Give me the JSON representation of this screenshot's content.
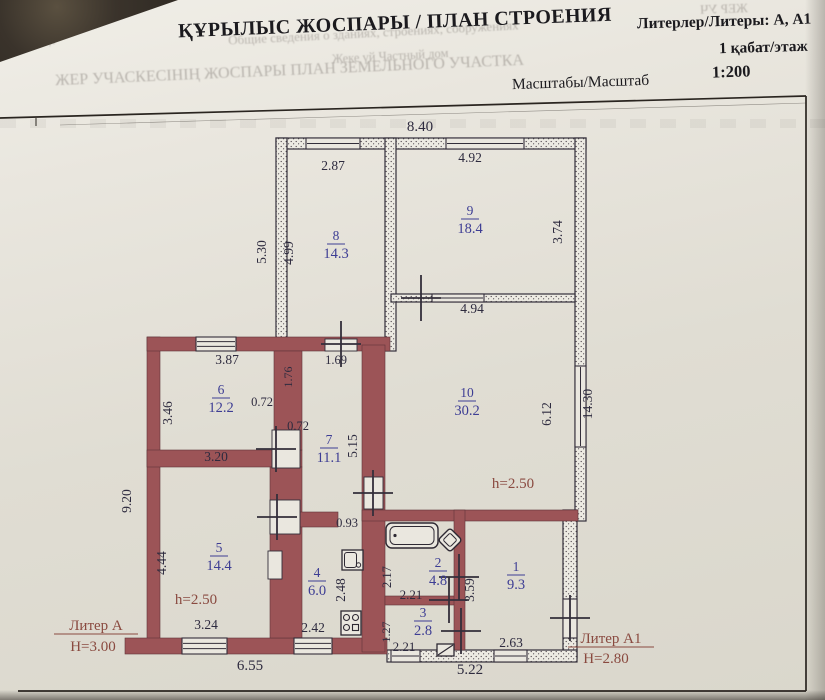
{
  "header": {
    "title": "ҚҰРЫЛЫС ЖОСПАРЫ / ПЛАН СТРОЕНИЯ",
    "liters": "Литерлер/Литеры: А, А1",
    "floor": "1 қабат/этаж",
    "scale_label": "Масштабы/Масштаб",
    "scale_value": "1:200"
  },
  "bleedthrough": [
    {
      "text": "Общие сведения о зданиях, строениях, сооружениях",
      "x": 228,
      "y": 25,
      "size": 13,
      "rot": -3,
      "mir": false
    },
    {
      "text": "Жеке үй    Частный дом",
      "x": 332,
      "y": 49,
      "size": 12.5,
      "rot": -3,
      "mir": false
    },
    {
      "text": "ЖЕР УЧАСКЕСІНІҢ ЖОСПАРЫ  ПЛАН ЗЕМЕЛЬНОГО УЧАСТКА",
      "x": 55,
      "y": 62,
      "size": 16,
      "rot": -2.5,
      "mir": false
    },
    {
      "text": "ЖЕР УЧ",
      "x": 700,
      "y": 1,
      "size": 13,
      "rot": 2,
      "mir": true
    },
    {
      "text": "қызметтер",
      "x": 2,
      "y": 34,
      "size": 12,
      "rot": 2,
      "mir": true
    }
  ],
  "colors": {
    "wall": "#9c5457",
    "wall_edge": "#5f3439",
    "line": "#332e3a",
    "hatch_bg": "#eceae2",
    "hatch_dot": "#4c434b",
    "dim_text": "#2e2b3f",
    "room_text": "#3d3d94",
    "note_text": "#8a4a40",
    "frame": "#2a2520",
    "fixture": "#2e2933",
    "white": "#eae7df"
  },
  "plan": {
    "frame": {
      "top_y": 96,
      "right_x": 806,
      "bottom_y": 691,
      "left_x": 36
    },
    "walls_solid": [
      [
        147,
        337,
        13,
        316
      ],
      [
        147,
        337,
        243,
        14
      ],
      [
        125,
        638,
        262,
        16
      ],
      [
        147,
        450,
        155,
        17
      ],
      [
        274,
        351,
        28,
        99
      ],
      [
        270,
        467,
        32,
        171
      ],
      [
        274,
        512,
        64,
        15
      ],
      [
        362,
        345,
        23,
        307
      ],
      [
        362,
        510,
        216,
        11
      ],
      [
        385,
        596,
        75,
        9
      ],
      [
        454,
        510,
        11,
        140
      ]
    ],
    "walls_hatched": [
      [
        276,
        138,
        310,
        11
      ],
      [
        276,
        138,
        11,
        213
      ],
      [
        385,
        138,
        11,
        213
      ],
      [
        575,
        138,
        11,
        383
      ],
      [
        391,
        294,
        184,
        8
      ],
      [
        563,
        510,
        14,
        148
      ],
      [
        387,
        650,
        190,
        12
      ]
    ],
    "windows": [
      {
        "r": [
          306,
          138,
          54,
          11
        ],
        "lines": 1
      },
      {
        "r": [
          446,
          138,
          78,
          11
        ],
        "lines": 1
      },
      {
        "r": [
          196,
          337,
          40,
          14
        ],
        "lines": 2
      },
      {
        "r": [
          182,
          638,
          45,
          16
        ],
        "lines": 2
      },
      {
        "r": [
          294,
          638,
          38,
          16
        ],
        "lines": 2
      },
      {
        "r": [
          575,
          366,
          11,
          81
        ],
        "lines": 1
      },
      {
        "r": [
          563,
          599,
          14,
          39
        ],
        "lines": 0
      },
      {
        "r": [
          432,
          294,
          52,
          8
        ],
        "lines": 1
      },
      {
        "r": [
          494,
          650,
          33,
          12
        ],
        "lines": 1
      },
      {
        "r": [
          391,
          650,
          29,
          12
        ],
        "lines": 1
      }
    ],
    "door_boxes": [
      [
        272,
        430,
        28,
        38
      ],
      [
        270,
        500,
        30,
        34
      ],
      [
        268,
        551,
        14,
        28
      ],
      [
        364,
        477,
        19,
        32
      ],
      [
        325,
        339,
        32,
        12
      ]
    ],
    "door_crosses": [
      [
        341,
        344
      ],
      [
        421,
        298
      ],
      [
        276,
        449
      ],
      [
        277,
        517
      ],
      [
        373,
        493
      ],
      [
        449,
        600
      ],
      [
        459,
        577
      ],
      [
        461,
        631
      ],
      [
        570,
        618
      ]
    ],
    "rooms": [
      {
        "number": "8",
        "area": "14.3",
        "x": 336,
        "y": 243
      },
      {
        "number": "9",
        "area": "18.4",
        "x": 470,
        "y": 218
      },
      {
        "number": "10",
        "area": "30.2",
        "x": 467,
        "y": 400
      },
      {
        "number": "6",
        "area": "12.2",
        "x": 221,
        "y": 397
      },
      {
        "number": "7",
        "area": "11.1",
        "x": 329,
        "y": 447
      },
      {
        "number": "5",
        "area": "14.4",
        "x": 219,
        "y": 555
      },
      {
        "number": "4",
        "area": "6.0",
        "x": 317,
        "y": 580
      },
      {
        "number": "2",
        "area": "4.8",
        "x": 438,
        "y": 570
      },
      {
        "number": "3",
        "area": "2.8",
        "x": 423,
        "y": 620
      },
      {
        "number": "1",
        "area": "9.3",
        "x": 516,
        "y": 574
      }
    ],
    "dims": [
      {
        "text": "8.40",
        "x": 420,
        "y": 131,
        "rot": 0,
        "size": 15
      },
      {
        "text": "2.87",
        "x": 333,
        "y": 170,
        "rot": 0
      },
      {
        "text": "4.92",
        "x": 470,
        "y": 162,
        "rot": 0
      },
      {
        "text": "5.30",
        "x": 266,
        "y": 252,
        "rot": -90
      },
      {
        "text": "4.99",
        "x": 293,
        "y": 253,
        "rot": -90
      },
      {
        "text": "3.74",
        "x": 562,
        "y": 232,
        "rot": -90
      },
      {
        "text": "4.94",
        "x": 472,
        "y": 313,
        "rot": 0
      },
      {
        "text": "14.30",
        "x": 592,
        "y": 404,
        "rot": -90
      },
      {
        "text": "6.12",
        "x": 551,
        "y": 414,
        "rot": -90
      },
      {
        "text": "3.87",
        "x": 227,
        "y": 364,
        "rot": 0
      },
      {
        "text": "1.69",
        "x": 336,
        "y": 364,
        "rot": 0,
        "size": 12.5
      },
      {
        "text": "1.76",
        "x": 292,
        "y": 377,
        "rot": -90,
        "size": 12
      },
      {
        "text": "0.72",
        "x": 262,
        "y": 406,
        "rot": 0,
        "size": 12.5
      },
      {
        "text": "0.72",
        "x": 298,
        "y": 430,
        "rot": 0,
        "size": 12.5
      },
      {
        "text": "3.46",
        "x": 172,
        "y": 413,
        "rot": -90
      },
      {
        "text": "3.20",
        "x": 216,
        "y": 461,
        "rot": 0
      },
      {
        "text": "5.15",
        "x": 357,
        "y": 446,
        "rot": -90
      },
      {
        "text": "9.20",
        "x": 131,
        "y": 501,
        "rot": -90
      },
      {
        "text": "4.44",
        "x": 166,
        "y": 563,
        "rot": -90
      },
      {
        "text": "3.24",
        "x": 206,
        "y": 629,
        "rot": 0
      },
      {
        "text": "0.93",
        "x": 347,
        "y": 527,
        "rot": 0,
        "size": 12.5
      },
      {
        "text": "2.48",
        "x": 345,
        "y": 590,
        "rot": -90
      },
      {
        "text": "2.42",
        "x": 313,
        "y": 632,
        "rot": 0
      },
      {
        "text": "6.55",
        "x": 250,
        "y": 670,
        "rot": 0,
        "size": 15
      },
      {
        "text": "2.17",
        "x": 391,
        "y": 577,
        "rot": -90,
        "size": 12.5
      },
      {
        "text": "2.21",
        "x": 411,
        "y": 599,
        "rot": 0,
        "size": 13
      },
      {
        "text": "1.27",
        "x": 390,
        "y": 632,
        "rot": -90,
        "size": 12
      },
      {
        "text": "2.21",
        "x": 404,
        "y": 651,
        "rot": 0,
        "size": 13
      },
      {
        "text": "3.59",
        "x": 474,
        "y": 590,
        "rot": -90
      },
      {
        "text": "2.63",
        "x": 511,
        "y": 647,
        "rot": 0
      },
      {
        "text": "5.22",
        "x": 470,
        "y": 674,
        "rot": 0,
        "size": 15
      }
    ],
    "notes": [
      {
        "text": "Литер А",
        "x": 96,
        "y": 630,
        "u": 84
      },
      {
        "text": "Н=3.00",
        "x": 93,
        "y": 651
      },
      {
        "text": "Литер А1",
        "x": 611,
        "y": 643,
        "u": 86
      },
      {
        "text": "Н=2.80",
        "x": 606,
        "y": 663
      },
      {
        "text": "h=2.50",
        "x": 513,
        "y": 488
      },
      {
        "text": "h=2.50",
        "x": 196,
        "y": 604
      }
    ],
    "fixtures": [
      {
        "type": "bathtub",
        "x": 386,
        "y": 523,
        "w": 52,
        "h": 25
      },
      {
        "type": "corner-sink",
        "x": 450,
        "y": 540,
        "w": 17,
        "h": 17
      },
      {
        "type": "kitchen-sink",
        "x": 342,
        "y": 550,
        "w": 21,
        "h": 20
      },
      {
        "type": "stove",
        "x": 341,
        "y": 611,
        "w": 20,
        "h": 24
      },
      {
        "type": "toilet",
        "x": 437,
        "y": 644,
        "w": 17,
        "h": 12
      }
    ]
  }
}
